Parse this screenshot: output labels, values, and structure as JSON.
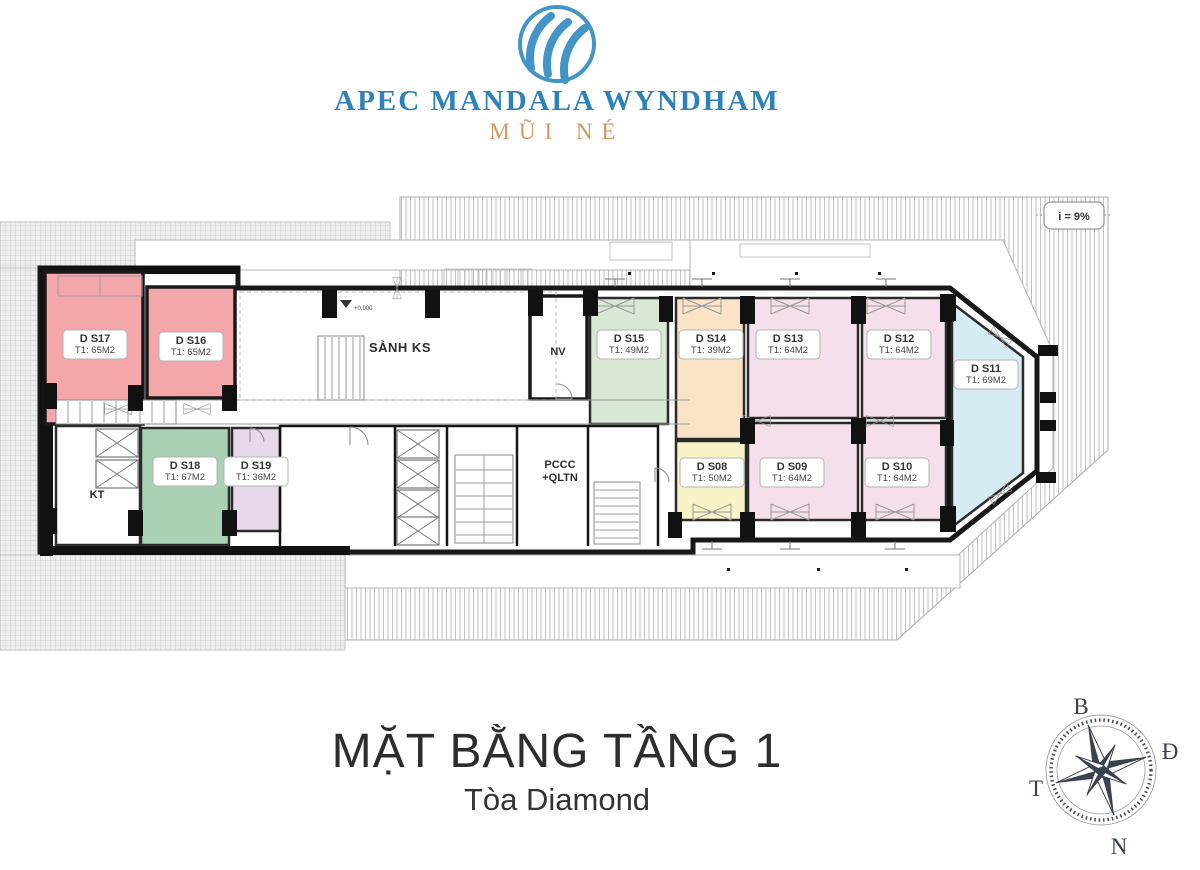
{
  "brand": {
    "name": "APEC MANDALA WYNDHAM",
    "location": "MŨI NÉ"
  },
  "title": {
    "main": "MẶT BẰNG TẦNG 1",
    "sub": "Tòa Diamond"
  },
  "plan": {
    "slope_label": "i = 9%",
    "level_marker": "+0.000",
    "lobby_label": "SẢNH KS",
    "staff_room_label": "NV",
    "technical_room_label": "KT",
    "fire_room_label_line1": "PCCC",
    "fire_room_label_line2": "+QLTN"
  },
  "rooms": [
    {
      "id": "DS17",
      "name": "D S17",
      "area": "T1: 65M2",
      "color": "#f4a7ab"
    },
    {
      "id": "DS16",
      "name": "D S16",
      "area": "T1: 65M2",
      "color": "#f4a7ab"
    },
    {
      "id": "DS15",
      "name": "D S15",
      "area": "T1: 49M2",
      "color": "#d9e8d4"
    },
    {
      "id": "DS14",
      "name": "D S14",
      "area": "T1: 39M2",
      "color": "#fbe3c8"
    },
    {
      "id": "DS13",
      "name": "D S13",
      "area": "T1: 64M2",
      "color": "#f6dfec"
    },
    {
      "id": "DS12",
      "name": "D S12",
      "area": "T1: 64M2",
      "color": "#f6dfec"
    },
    {
      "id": "DS11",
      "name": "D S11",
      "area": "T1: 69M2",
      "color": "#d7ebf4"
    },
    {
      "id": "DS18",
      "name": "D S18",
      "area": "T1: 67M2",
      "color": "#aad2b2"
    },
    {
      "id": "DS19",
      "name": "D S19",
      "area": "T1: 36M2",
      "color": "#e7d8ec"
    },
    {
      "id": "DS08",
      "name": "D S08",
      "area": "T1: 50M2",
      "color": "#f9f3c8"
    },
    {
      "id": "DS09",
      "name": "D S09",
      "area": "T1: 64M2",
      "color": "#f6dfec"
    },
    {
      "id": "DS10",
      "name": "D S10",
      "area": "T1: 64M2",
      "color": "#f6dfec"
    }
  ],
  "compass": {
    "north": "B",
    "east": "Đ",
    "south": "N",
    "west": "T"
  }
}
